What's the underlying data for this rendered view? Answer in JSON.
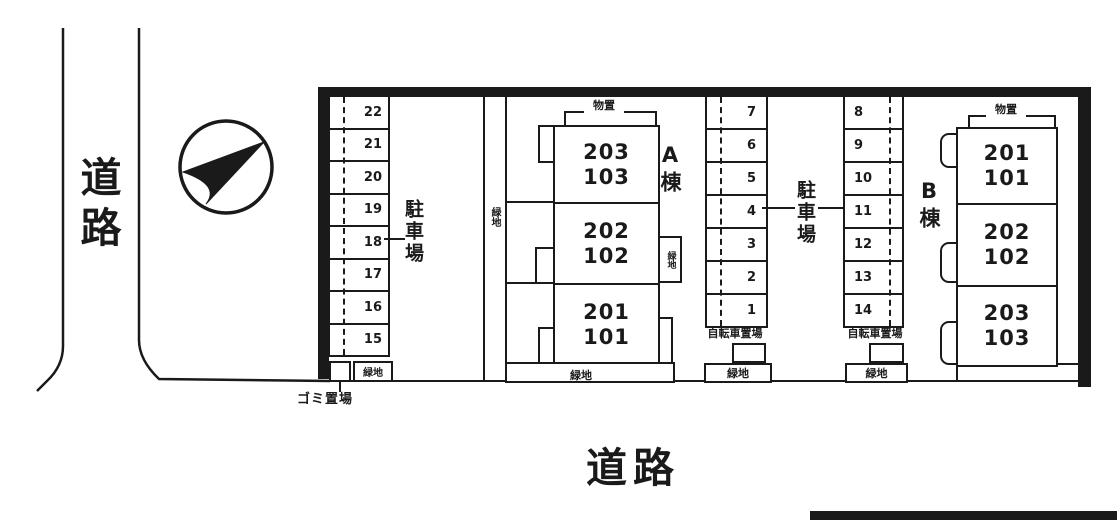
{
  "plan": {
    "ink_color": "#1a1a1a",
    "road_left": "道路",
    "road_bottom": "道路",
    "compass": "north-arrow",
    "parking_left": {
      "label": "駐車場",
      "spaces": [
        "22",
        "21",
        "20",
        "19",
        "18",
        "17",
        "16",
        "15"
      ]
    },
    "parking_middle": {
      "label": "駐車場",
      "left_spaces": [
        "7",
        "6",
        "5",
        "4",
        "3",
        "2",
        "1"
      ],
      "right_spaces": [
        "8",
        "9",
        "10",
        "11",
        "12",
        "13",
        "14"
      ]
    },
    "building_a": {
      "name": "A棟",
      "storage": "物置",
      "units": [
        [
          "203",
          "103"
        ],
        [
          "202",
          "102"
        ],
        [
          "201",
          "101"
        ]
      ]
    },
    "building_b": {
      "name": "B棟",
      "storage": "物置",
      "units": [
        [
          "201",
          "101"
        ],
        [
          "202",
          "102"
        ],
        [
          "203",
          "103"
        ]
      ]
    },
    "bicycle_parking": "自転車置場",
    "garbage": "ゴミ置場",
    "green": "緑地"
  }
}
